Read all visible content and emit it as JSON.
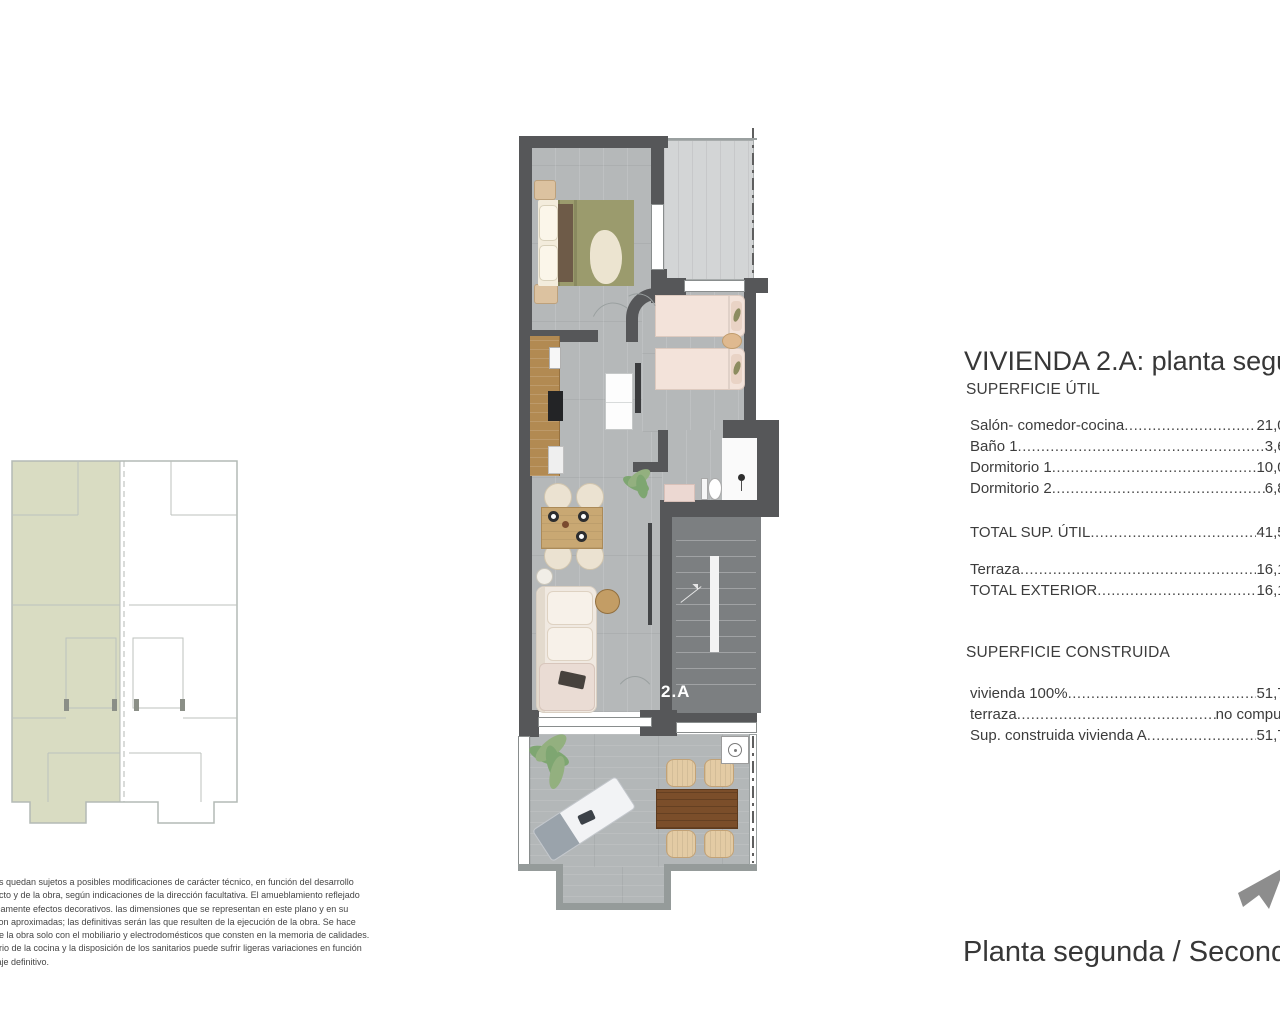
{
  "document": {
    "title": "VIVIENDA 2.A: planta segunda",
    "caption": "Planta segunda / Second floor",
    "unit_label": "2.A"
  },
  "superficie_util": {
    "heading": "SUPERFICIE ÚTIL",
    "rows": [
      {
        "label": "Salón- comedor-cocina",
        "value": "21,06"
      },
      {
        "label": "Baño 1",
        "value": "3,61"
      },
      {
        "label": "Dormitorio 1",
        "value": "10,01"
      },
      {
        "label": "Dormitorio 2",
        "value": "6,84"
      }
    ],
    "total": {
      "label": "TOTAL SUP. ÚTIL",
      "value": "41,52"
    },
    "exterior_rows": [
      {
        "label": "Terraza",
        "value": "16,17"
      },
      {
        "label": "TOTAL EXTERIOR",
        "value": "16,17"
      }
    ]
  },
  "superficie_construida": {
    "heading": "SUPERFICIE CONSTRUIDA",
    "rows": [
      {
        "label": "vivienda 100%",
        "value": "51,74"
      },
      {
        "label": "terraza",
        "value": "no computa"
      },
      {
        "label": "Sup. construida vivienda A",
        "value": "51,74"
      }
    ]
  },
  "disclaimer": {
    "lines": [
      "os quedan sujetos a posibles modificaciones de carácter técnico, en función del desarrollo",
      "ecto y de la obra, según indicaciones de la dirección facultativa. El amueblamiento reflejado",
      "icamente efectos decorativos. las dimensiones que se representan en este plano y en su",
      "son aproximadas; las definitivas serán las que resulten de la ejecución de la obra. Se hace",
      "de la obra solo con el mobiliario y electrodomésticos que consten en la memoria de calidades.",
      "ario de la cocina y la disposición de los sanitarios puede sufrir ligeras variaciones en función",
      "taje definitivo."
    ]
  },
  "colors": {
    "wall": "#565759",
    "interior_floor": "#b5b8b9",
    "stairwell": "#7c7f81",
    "upper_terrace": "#d3d5d6",
    "keyplan_highlight": "#d9dcc2",
    "bed_olive": "#9b9b6d",
    "kitchen_wood": "#b28a52",
    "outdoor_table_wood": "#7b4e2a"
  }
}
